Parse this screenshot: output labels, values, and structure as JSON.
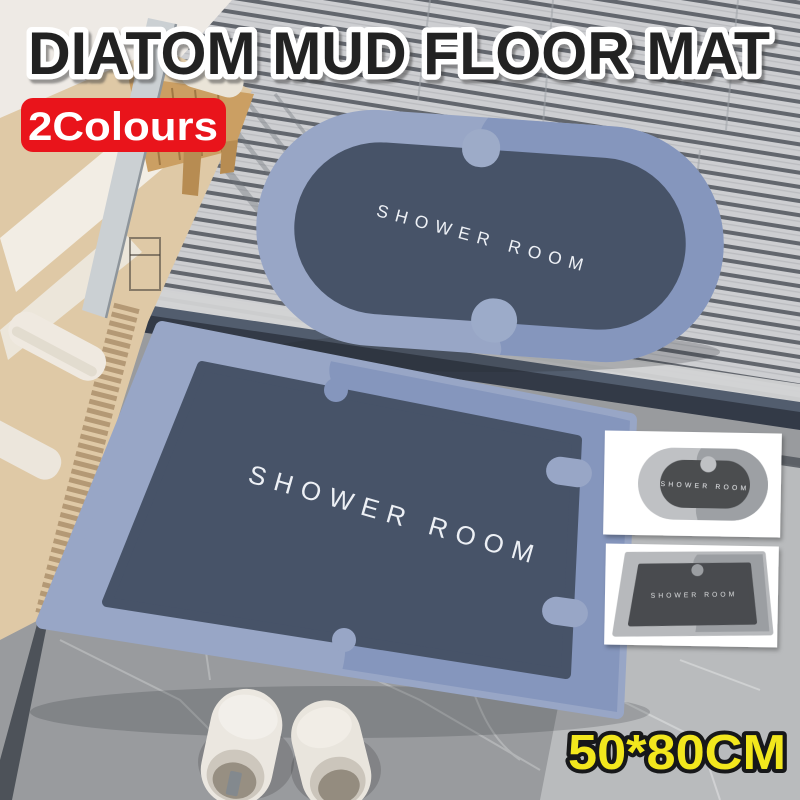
{
  "title": "DIATOM MUD FLOOR MAT",
  "badge": {
    "label": "2Colours",
    "bg": "#e9141b",
    "text_color": "#ffffff"
  },
  "size_label": "50*80CM",
  "colors": {
    "title_fill": "#242424",
    "title_outline": "#ffffff",
    "size_fill": "#f2e71d",
    "size_outline": "#17181a",
    "mat_border_light": "#98a6c6",
    "mat_border_shade": "#8596bd",
    "mat_center": "#475368",
    "thumb_border_light": "#bfc1c4",
    "thumb_border_shade": "#9da0a4",
    "thumb_center": "#4b4d50"
  },
  "mats": {
    "oval_label": "SHOWER ROOM",
    "rect_label": "SHOWER ROOM"
  },
  "thumbnails": [
    {
      "shape": "oval",
      "label": "SHOWER ROOM"
    },
    {
      "shape": "rectangle",
      "label": "SHOWER ROOM"
    }
  ]
}
